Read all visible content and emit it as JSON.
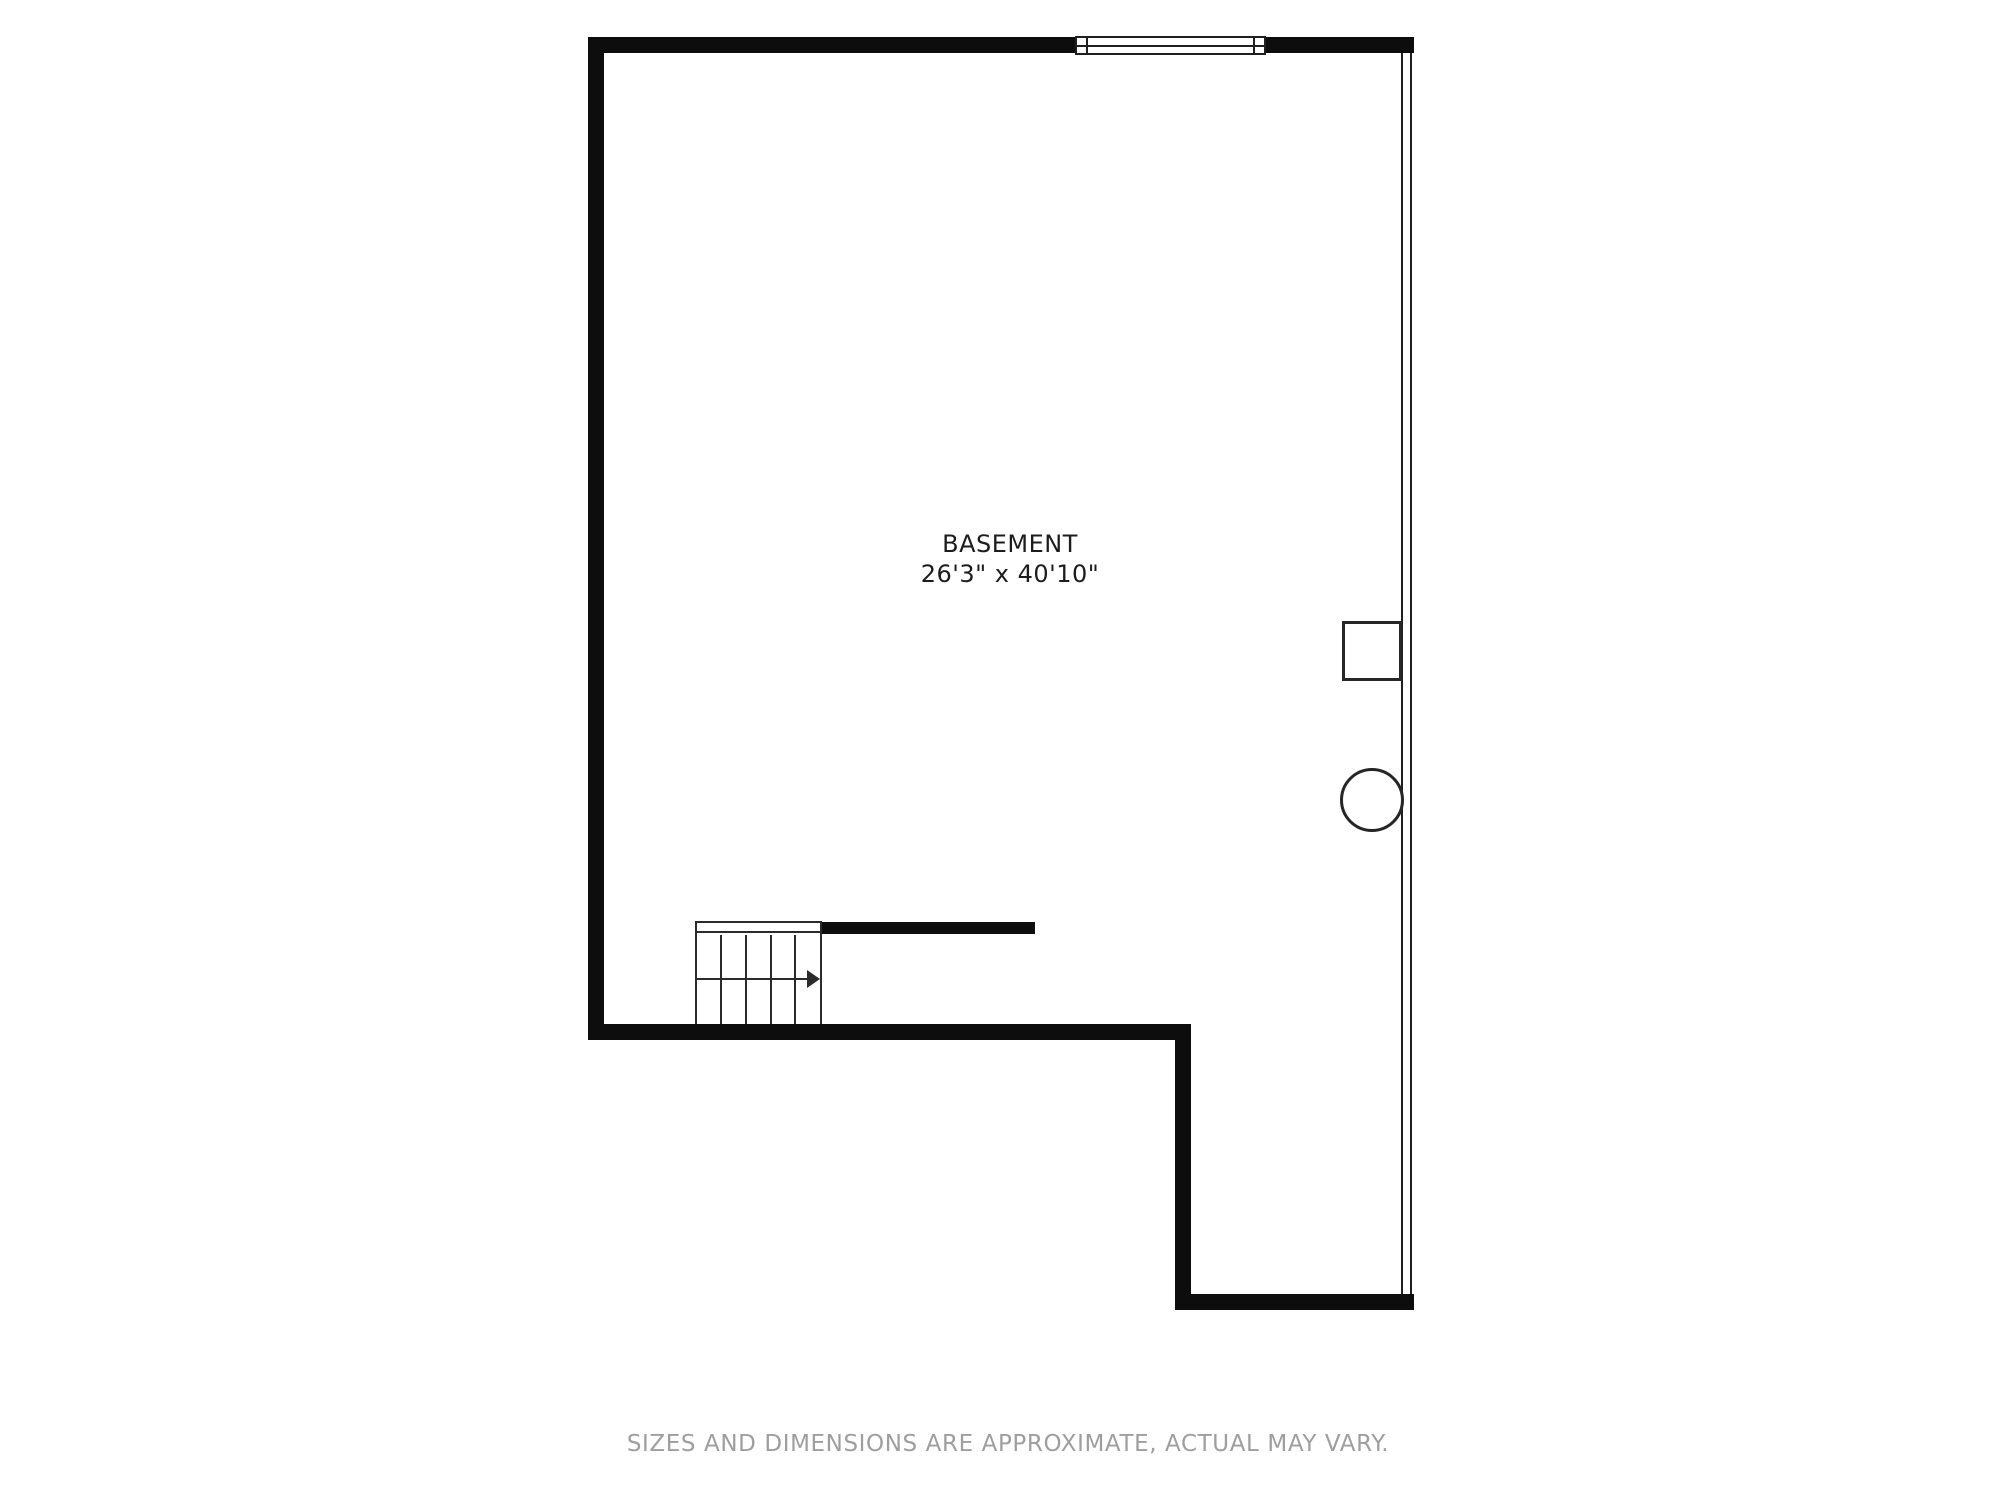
{
  "page": {
    "background_color": "#ffffff"
  },
  "plan": {
    "room": {
      "name": "BASEMENT",
      "dimensions": "26'3\" x 40'10\""
    },
    "footer": {
      "disclaimer": "SIZES AND DIMENSIONS ARE APPROXIMATE, ACTUAL MAY VARY."
    },
    "colors": {
      "wall": "#0d0d0d",
      "thin_line": "#1f1f1f",
      "symbol_line": "#262626",
      "stair_line": "#2b2b2b",
      "label_text": "#1c1c1c",
      "disclaimer_text": "#9e9e9e"
    },
    "symbols": {
      "window": "window-symbol",
      "utility_box": "utility-box-symbol",
      "column": "round-column-symbol",
      "stairs": {
        "name": "staircase-symbol",
        "treads": 5,
        "direction_arrow": "right"
      }
    }
  }
}
